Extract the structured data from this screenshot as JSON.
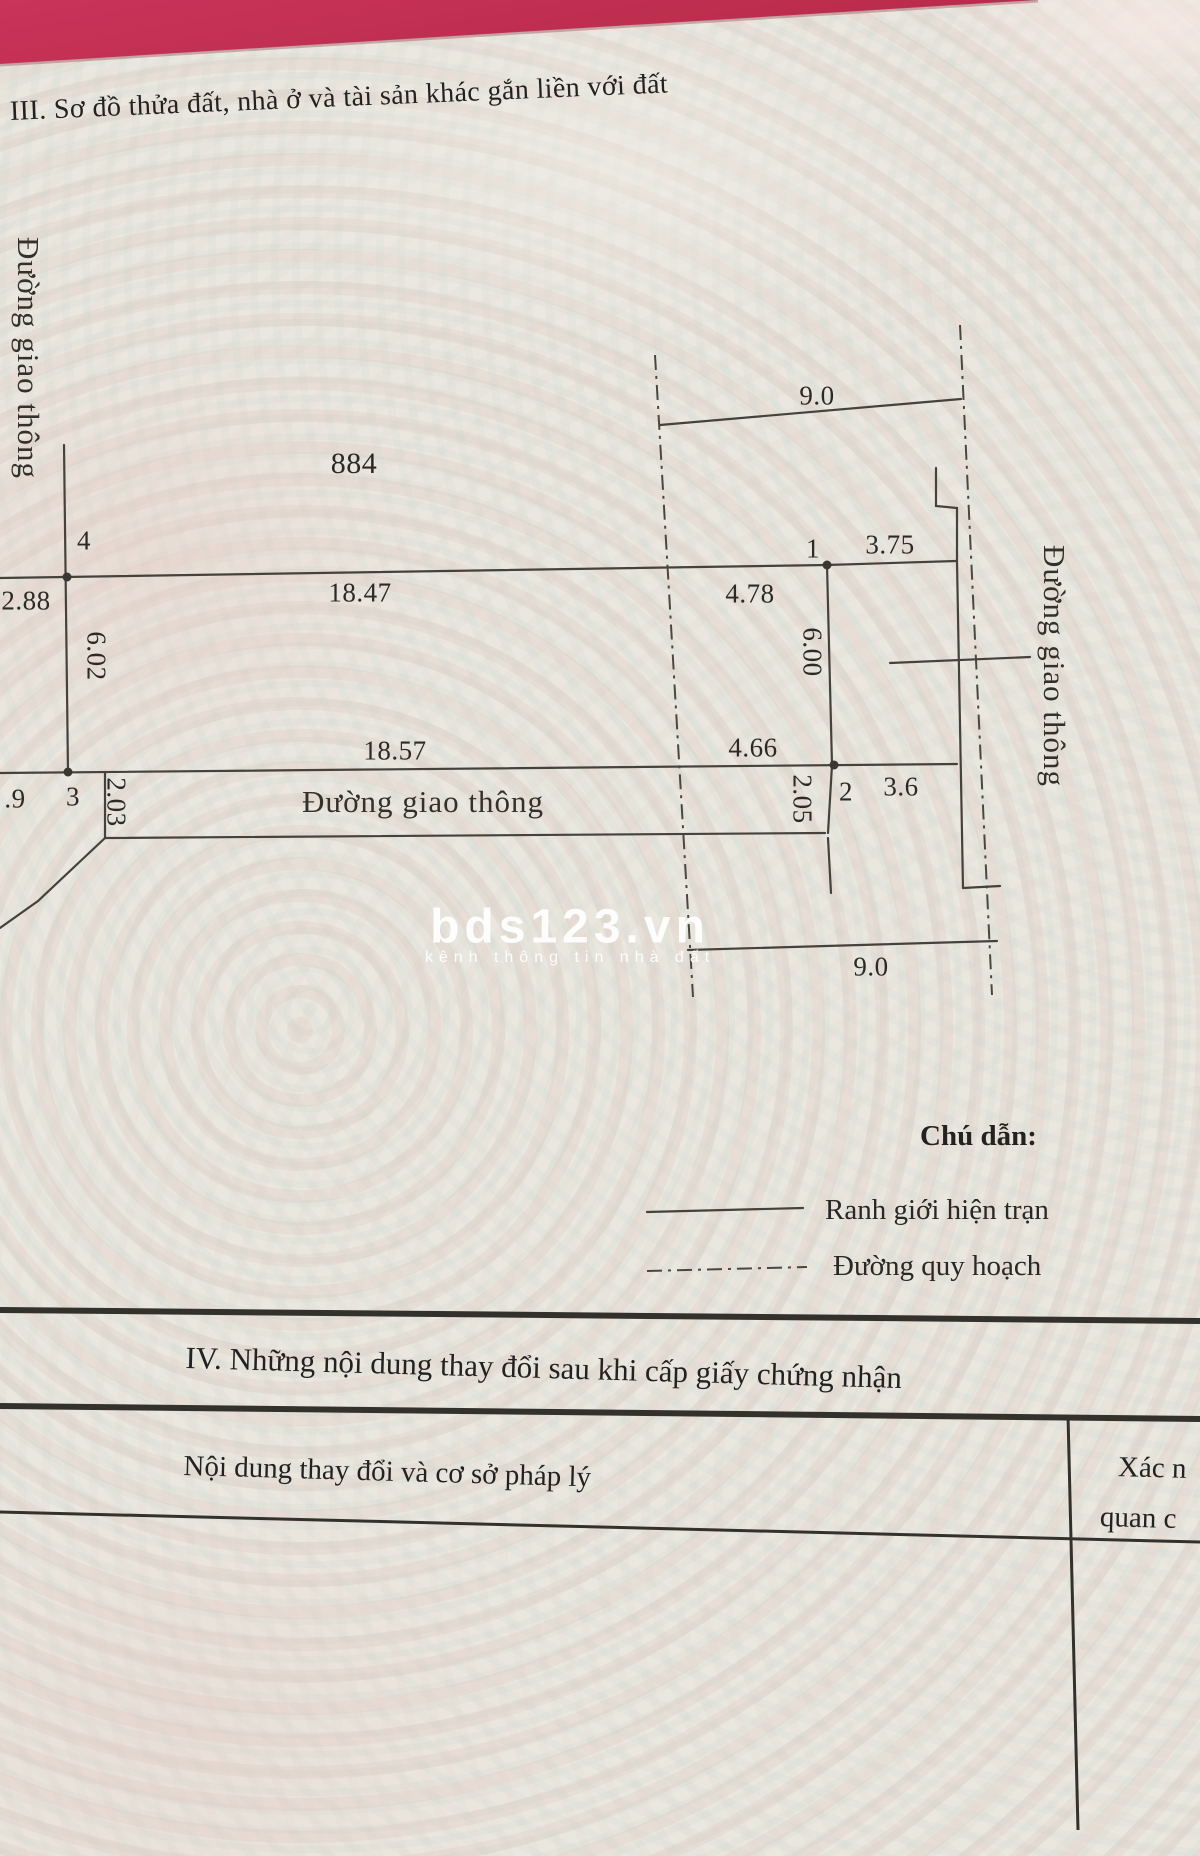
{
  "document": {
    "section_iii_title": "III. Sơ đồ thửa đất, nhà ở và tài sản khác gắn liền với đất",
    "section_iv_title": "IV. Những nội dung thay đổi sau khi cấp giấy chứng nhận"
  },
  "diagram": {
    "parcel_number": "884",
    "road_labels": {
      "left": "Đường giao thông",
      "bottom": "Đường giao thông",
      "right": "Đường giao thông"
    },
    "dimensions": {
      "top_left": "2.88",
      "top_edge": "18.47",
      "top_edge_right": "4.78",
      "planned_width_top": "9.0",
      "right_top": "3.75",
      "left_side": "6.02",
      "mid_side": "6.00",
      "bottom_edge": "18.57",
      "bottom_edge_right": "4.66",
      "left_road_bottom": ".9",
      "left_strip": "2.03",
      "mid_strip": "2.05",
      "right_bottom": "3.6",
      "planned_width_bottom": "9.0"
    },
    "corner_points": {
      "p1": "1",
      "p2": "2",
      "p3": "3",
      "p4": "4"
    }
  },
  "legend": {
    "title": "Chú dẫn:",
    "solid_label": "Ranh giới hiện trạn",
    "dashdot_label": "Đường quy hoạch"
  },
  "watermark": {
    "brand": "bds123.vn",
    "tagline": "kênh thông tin nhà đất"
  },
  "table": {
    "col_changes_header": "Nội dung thay đổi và cơ sở pháp lý",
    "col_confirm_line1": "Xác n",
    "col_confirm_line2": "quan c"
  }
}
